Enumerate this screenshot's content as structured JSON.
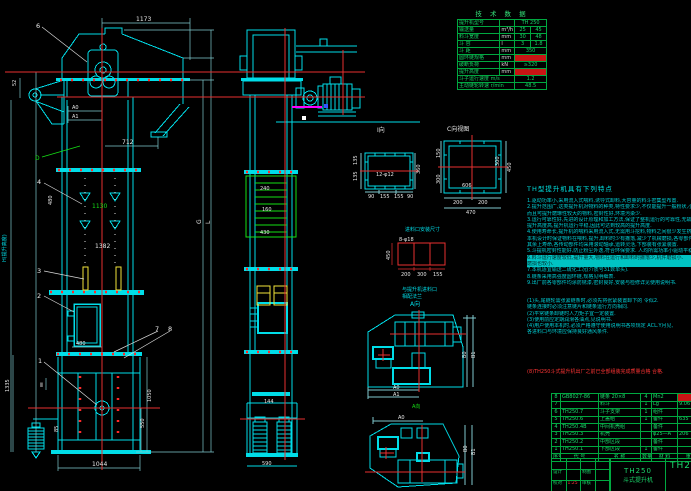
{
  "colors": {
    "line": "#00dde8",
    "green": "#15e015",
    "red": "#e83030",
    "yellow": "#f2e33a",
    "magenta": "#ff00ff",
    "table_green": "#1bd86b"
  },
  "fv": {
    "b6": "6",
    "b4": "4",
    "b3": "3",
    "b2": "2",
    "b1": "1",
    "b7": "7",
    "b8": "8",
    "d1173": "1173",
    "d712": "712",
    "a0": "A0",
    "a1": "A1",
    "d52": "52",
    "dD": "D",
    "d1130": "1130",
    "d1382": "1382",
    "d480a": "480",
    "d480b": "480",
    "d1050": "1050",
    "d550": "550",
    "d1044": "1044",
    "d1335": "1335",
    "d85": "85",
    "g": "G",
    "l": "L",
    "h": "H(提升高度)",
    "sec": "Ⅱ"
  },
  "sv": {
    "d240": "240",
    "d160": "160",
    "d430": "430",
    "d144": "144",
    "d590": "590"
  },
  "dv": {
    "i_label": "I向",
    "i_bolt": "12-φ12",
    "i_l1": "135",
    "i_l2": "135",
    "i_r": "360",
    "i_b1": "90",
    "i_b2": "155",
    "i_b3": "155",
    "i_b4": "90",
    "c_label": "C向视图",
    "c_b1": "200",
    "c_b2": "200",
    "c_b3": "470",
    "c_r1": "450",
    "c_r2": "300",
    "c_l1": "150",
    "c_l2": "300",
    "c_in": "606",
    "r_title": "进料口安装尺寸",
    "r_bolt": "8-φ18",
    "r_b1": "200",
    "r_b2": "300",
    "r_b3": "155",
    "r_l": "450",
    "lbl1": "与提升机进料口",
    "lbl2": "相配法兰",
    "a_dir": "A向",
    "a_dir2": "A向",
    "t1_a0": "A0",
    "t1_a1": "A1",
    "t1_b0": "B0",
    "t1_b1": "B1",
    "t2_a0": "A0",
    "t2_b0": "B0",
    "t2_b1": "B1"
  },
  "tech": {
    "title": "技 术 数 据",
    "rows": [
      {
        "l": "提升机型号",
        "u": "",
        "v1": "TH 250",
        "v2": ""
      },
      {
        "l": "输送量",
        "u": "m³/h",
        "v1": "25",
        "v2": "45"
      },
      {
        "l": "料斗宽度",
        "u": "mm",
        "v1": "30",
        "v2": "48"
      },
      {
        "l": "斗  容",
        "u": "l",
        "v1": "3",
        "v2": "1.8"
      },
      {
        "l": "斗  距",
        "u": "mm",
        "v1": "350",
        "v2": ""
      },
      {
        "l": "圆环链规格",
        "u": "mm",
        "v1": "",
        "v2": ""
      },
      {
        "l": "破断负荷",
        "u": "kN",
        "v1": "≥320",
        "v2": ""
      },
      {
        "l": "提升高度",
        "u": "mm",
        "v1": "",
        "v2": ""
      },
      {
        "l": "斗子运行速度 m/s",
        "u": "",
        "v1": "1.2",
        "v2": ""
      },
      {
        "l": "主动链轮转速 r/min",
        "u": "",
        "v1": "48.5",
        "v2": ""
      }
    ]
  },
  "features": {
    "title": "TH型提升机具有下列特点",
    "lines": [
      "1.驱动功率小,采用流入式喂料,诱导式卸料,大容量的料斗密集型布置.",
      "2.提升范围广,这类提升机对物料的种类,特性要求少,不仅能提升一般粉状,小颗粒物料,",
      "  而且可提升磨琢性较大的物料,密封性好,环境污染少.",
      "3.运行可靠性好,先进的设计原理和加工方法,保证了整机运行的可靠性,无故障时间超过2万小时.",
      "  提升高度高,提升机运行平稳,因此可达到较高的提升高度.",
      "4.使用寿命长,提升机的喂料采用流入式,无需用斗挖料,物料之间很少发生挤压和碰撞现象.",
      "  本机设计时保证物料在喂料,提升,卸料时少有撒落,减少了机械磨损,各零部件使用寿命长.",
      "  其余上寿命,各传动部件均采用滚动轴承,运转灵活,下部装有张紧装置.",
      "5.斗提机密封性能好,防止粉尘外逸,符合环保要求. 人均所需功率小驱动平稳噪音小,寿命长",
      "6.料斗运行速度较低,提升量大,物料在运行和卸料时撒落少,机件磨损小.",
      "  磨损也较小.",
      "7.本机适宜输送二硫化工况(介质号31数单头).",
      "8.链条采用高强度圆环链,规格见明细表.",
      "9.出厂前各零部件均涂防锈漆,密封良好,安装与检修详见使用说明书."
    ],
    "notes": [
      "(1)头,尾链轮需张紧链条时,必须先将张紧装置卸下的 令似2.",
      "  链条连接时必须注意链片和链条运行方向相同.",
      "(2)平常链条卸链时人力矩子宜一定装置.",
      "(3)使用前应定期润滑各油点,见说明书.",
      "(4)用户使用本机时,必须严格遵守使用说明书各项规定 ACL.Y月见,",
      "  各进料口与环境应保持良好通风条件."
    ],
    "note_red": "(8)TH250斗式提升机出厂之前已全部组装完成质量合格 合格."
  },
  "bom": {
    "rows": [
      {
        "no": "8",
        "code": "GB8027-86",
        "name": "链条 20×8",
        "qty": "4",
        "mat": "Mn2",
        "wt": ""
      },
      {
        "no": "7",
        "code": "",
        "name": "料斗",
        "qty": "1",
        "mat": "Lg",
        "wt": "9.06"
      },
      {
        "no": "6",
        "code": "TH250.7",
        "name": "斗子支架",
        "qty": "1",
        "mat": "组件",
        "wt": ""
      },
      {
        "no": "5",
        "code": "TH250.6",
        "name": "上盖组",
        "qty": "1",
        "mat": "备件",
        "wt": "635"
      },
      {
        "no": "4",
        "code": "TH250.4B",
        "name": "中间机壳组",
        "qty": "",
        "mat": "备件",
        "wt": ""
      },
      {
        "no": "3",
        "code": "TH250.3",
        "name": "机壳",
        "qty": "",
        "mat": "φ25—A",
        "wt": "206"
      },
      {
        "no": "2",
        "code": "TH250.2",
        "name": "中部区段",
        "qty": "",
        "mat": "备件",
        "wt": ""
      },
      {
        "no": "1",
        "code": "TH250.1",
        "name": "下部区段",
        "qty": "1",
        "mat": "备件",
        "wt": ""
      }
    ],
    "header": {
      "no": "序号",
      "code": "代 号",
      "name": "名 称",
      "qty": "数量",
      "mat": "材 料",
      "wt": "重 量"
    }
  },
  "tb": {
    "model": "TH250",
    "name": "斗式提升机",
    "right": "TH2",
    "c1": "设计",
    "c2": "制图",
    "c3": "校对",
    "c4": "审核",
    "scale": "1:25"
  }
}
